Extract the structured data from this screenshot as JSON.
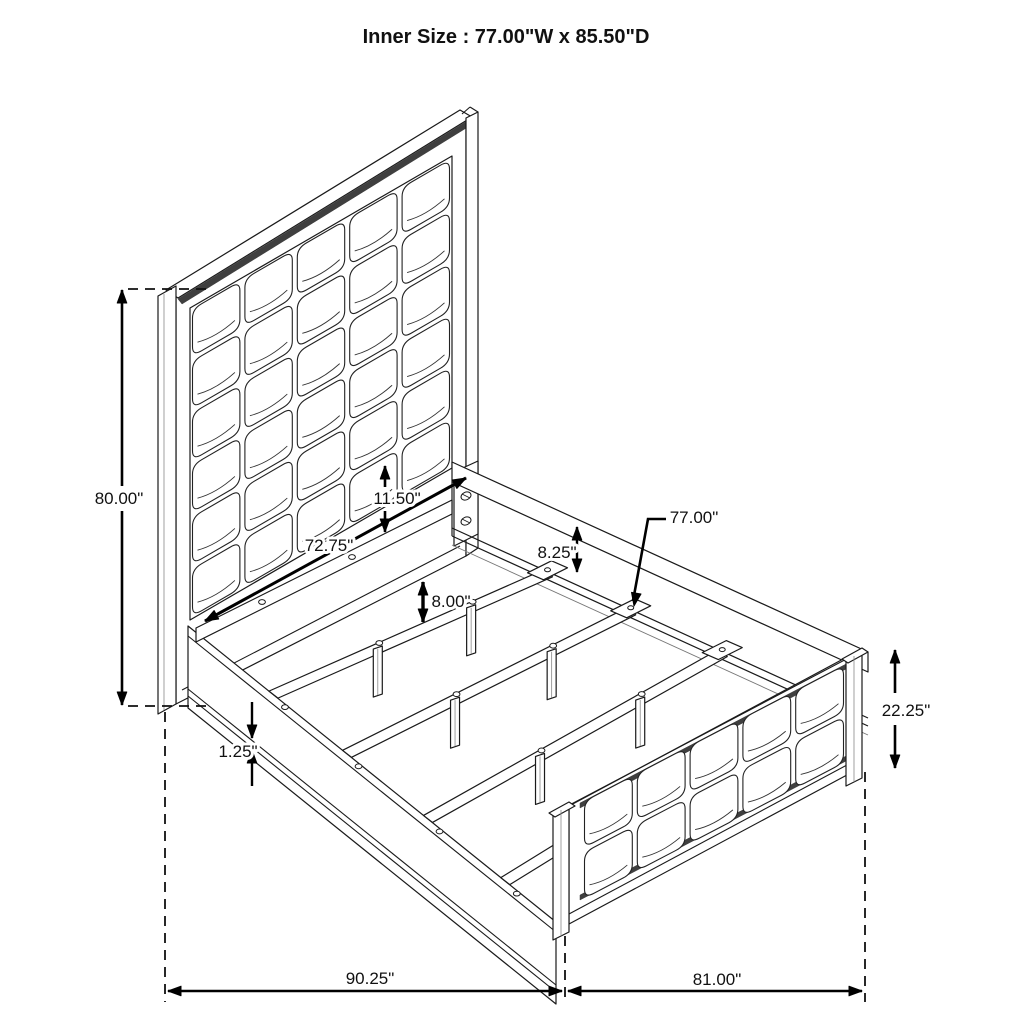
{
  "title": "Inner Size : 77.00\"W x 85.50\"D",
  "dimensions": {
    "headboard_height": "80.00\"",
    "panel_to_rail_gap": "11.50\"",
    "headboard_inner_width": "72.75\"",
    "rail_height_above_slat": "8.25\"",
    "slat_width": "77.00\"",
    "support_leg_height": "8.00\"",
    "rail_lip_thickness": "1.25\"",
    "footboard_height": "22.25\"",
    "overall_length_headboard_side": "90.25\"",
    "overall_length_footboard_side": "81.00\""
  }
}
